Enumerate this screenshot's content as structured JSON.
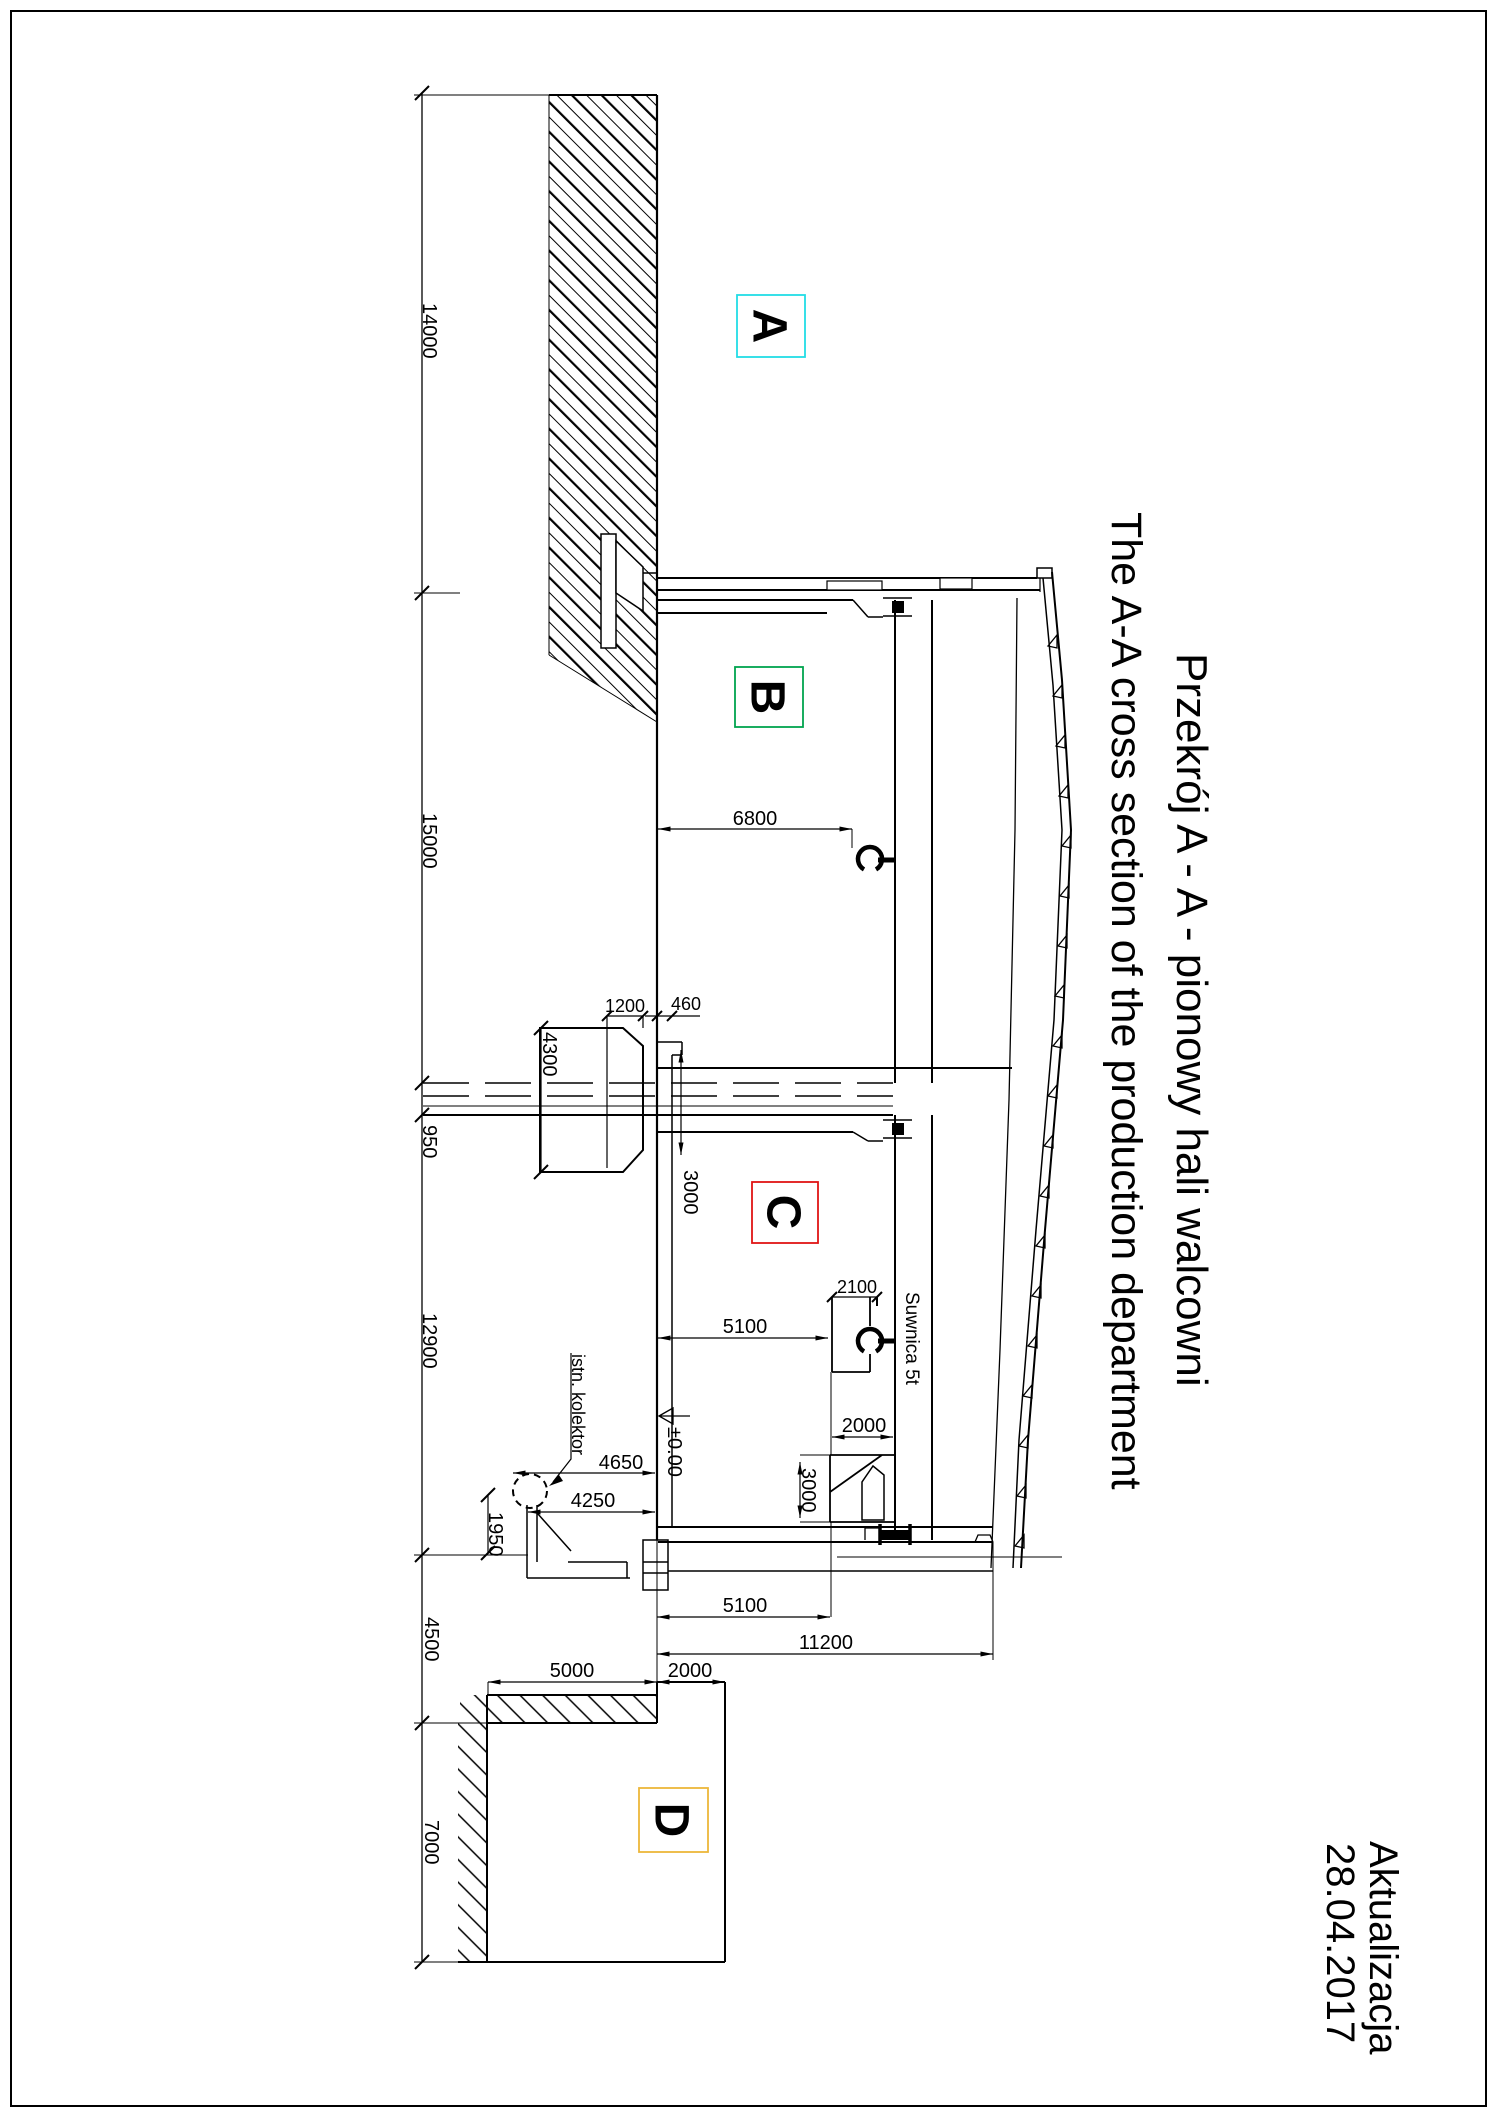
{
  "page": {
    "background": "#ffffff",
    "border_color": "#000000",
    "line_color": "#000000"
  },
  "titles": {
    "line1_pl": "Przekrój A - A - pionowy hali walcowni",
    "line2_en": "The A-A cross section of the production department",
    "update_label": "Aktualizacja",
    "update_date": "28.04.2017"
  },
  "section_labels": [
    {
      "letter": "A",
      "color": "#22dde6"
    },
    {
      "letter": "B",
      "color": "#00a44f"
    },
    {
      "letter": "C",
      "color": "#e01414"
    },
    {
      "letter": "D",
      "color": "#edb73b"
    }
  ],
  "annotations": {
    "crane": "Suwnica 5t",
    "collector": "istn. kolektor",
    "level": "±0.00"
  },
  "dims": {
    "d14000": "14000",
    "d15000": "15000",
    "d950": "950",
    "d12900": "12900",
    "d4500": "4500",
    "d7000": "7000",
    "d6800": "6800",
    "d1200": "1200",
    "d460": "460",
    "d4300": "4300",
    "d3000_wall": "3000",
    "d5100_c": "5100",
    "d2100": "2100",
    "d2000_c": "2000",
    "d3000_bracket": "3000",
    "d4650": "4650",
    "d4250": "4250",
    "d1950": "1950",
    "d5100_d": "5100",
    "d11200": "11200",
    "d5000": "5000",
    "d2000_d": "2000"
  }
}
